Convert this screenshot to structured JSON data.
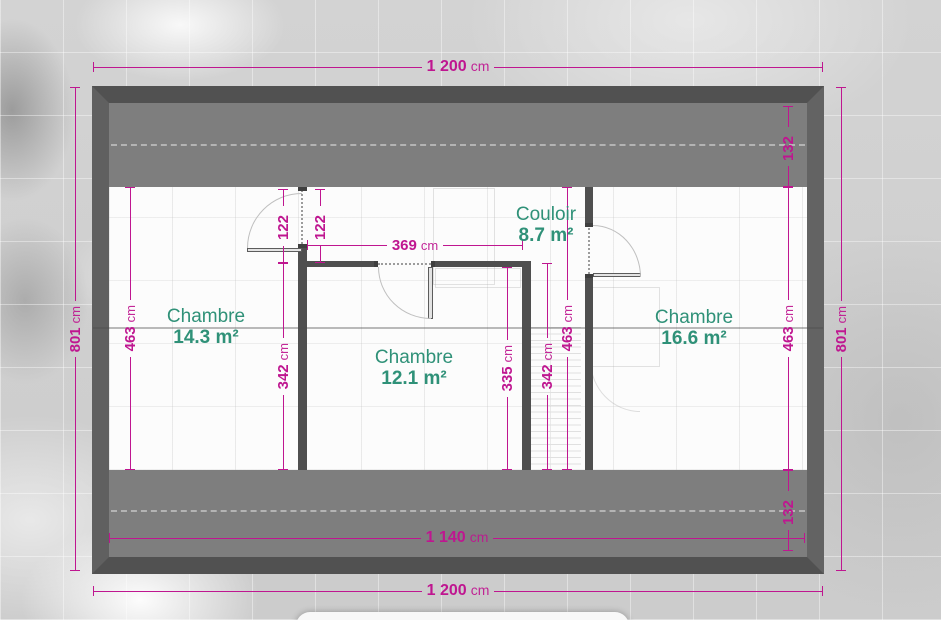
{
  "colors": {
    "dimension_accent": "#bf1690",
    "room_label": "#2f9178",
    "wall": "#515151",
    "roof_band": "#7e7e7e"
  },
  "rooms": [
    {
      "name": "Chambre",
      "area": "14.3 m²"
    },
    {
      "name": "Chambre",
      "area": "12.1 m²"
    },
    {
      "name": "Couloir",
      "area": "8.7 m²"
    },
    {
      "name": "Chambre",
      "area": "16.6 m²"
    }
  ],
  "dimensions": {
    "top_width": {
      "value": "1 200",
      "unit": "cm"
    },
    "bottom_width": {
      "value": "1 200",
      "unit": "cm"
    },
    "inner_width": {
      "value": "1 140",
      "unit": "cm"
    },
    "left_height": {
      "value": "801",
      "unit": "cm"
    },
    "right_height": {
      "value": "801",
      "unit": "cm"
    },
    "left_room_depth": {
      "value": "463",
      "unit": "cm"
    },
    "middle_depth": {
      "value": "463",
      "unit": "cm"
    },
    "right_room_depth": {
      "value": "463",
      "unit": "cm"
    },
    "left_door_offset": {
      "value": "122",
      "unit": ""
    },
    "right_door_offset": {
      "value": "122",
      "unit": ""
    },
    "corridor_length": {
      "value": "369",
      "unit": "cm"
    },
    "left_lower_depth": {
      "value": "342",
      "unit": "cm"
    },
    "stair_depth": {
      "value": "342",
      "unit": "cm"
    },
    "room2_inner_depth": {
      "value": "335",
      "unit": "cm"
    },
    "top_eave_depth": {
      "value": "132",
      "unit": ""
    },
    "bottom_eave_depth": {
      "value": "132",
      "unit": ""
    }
  }
}
